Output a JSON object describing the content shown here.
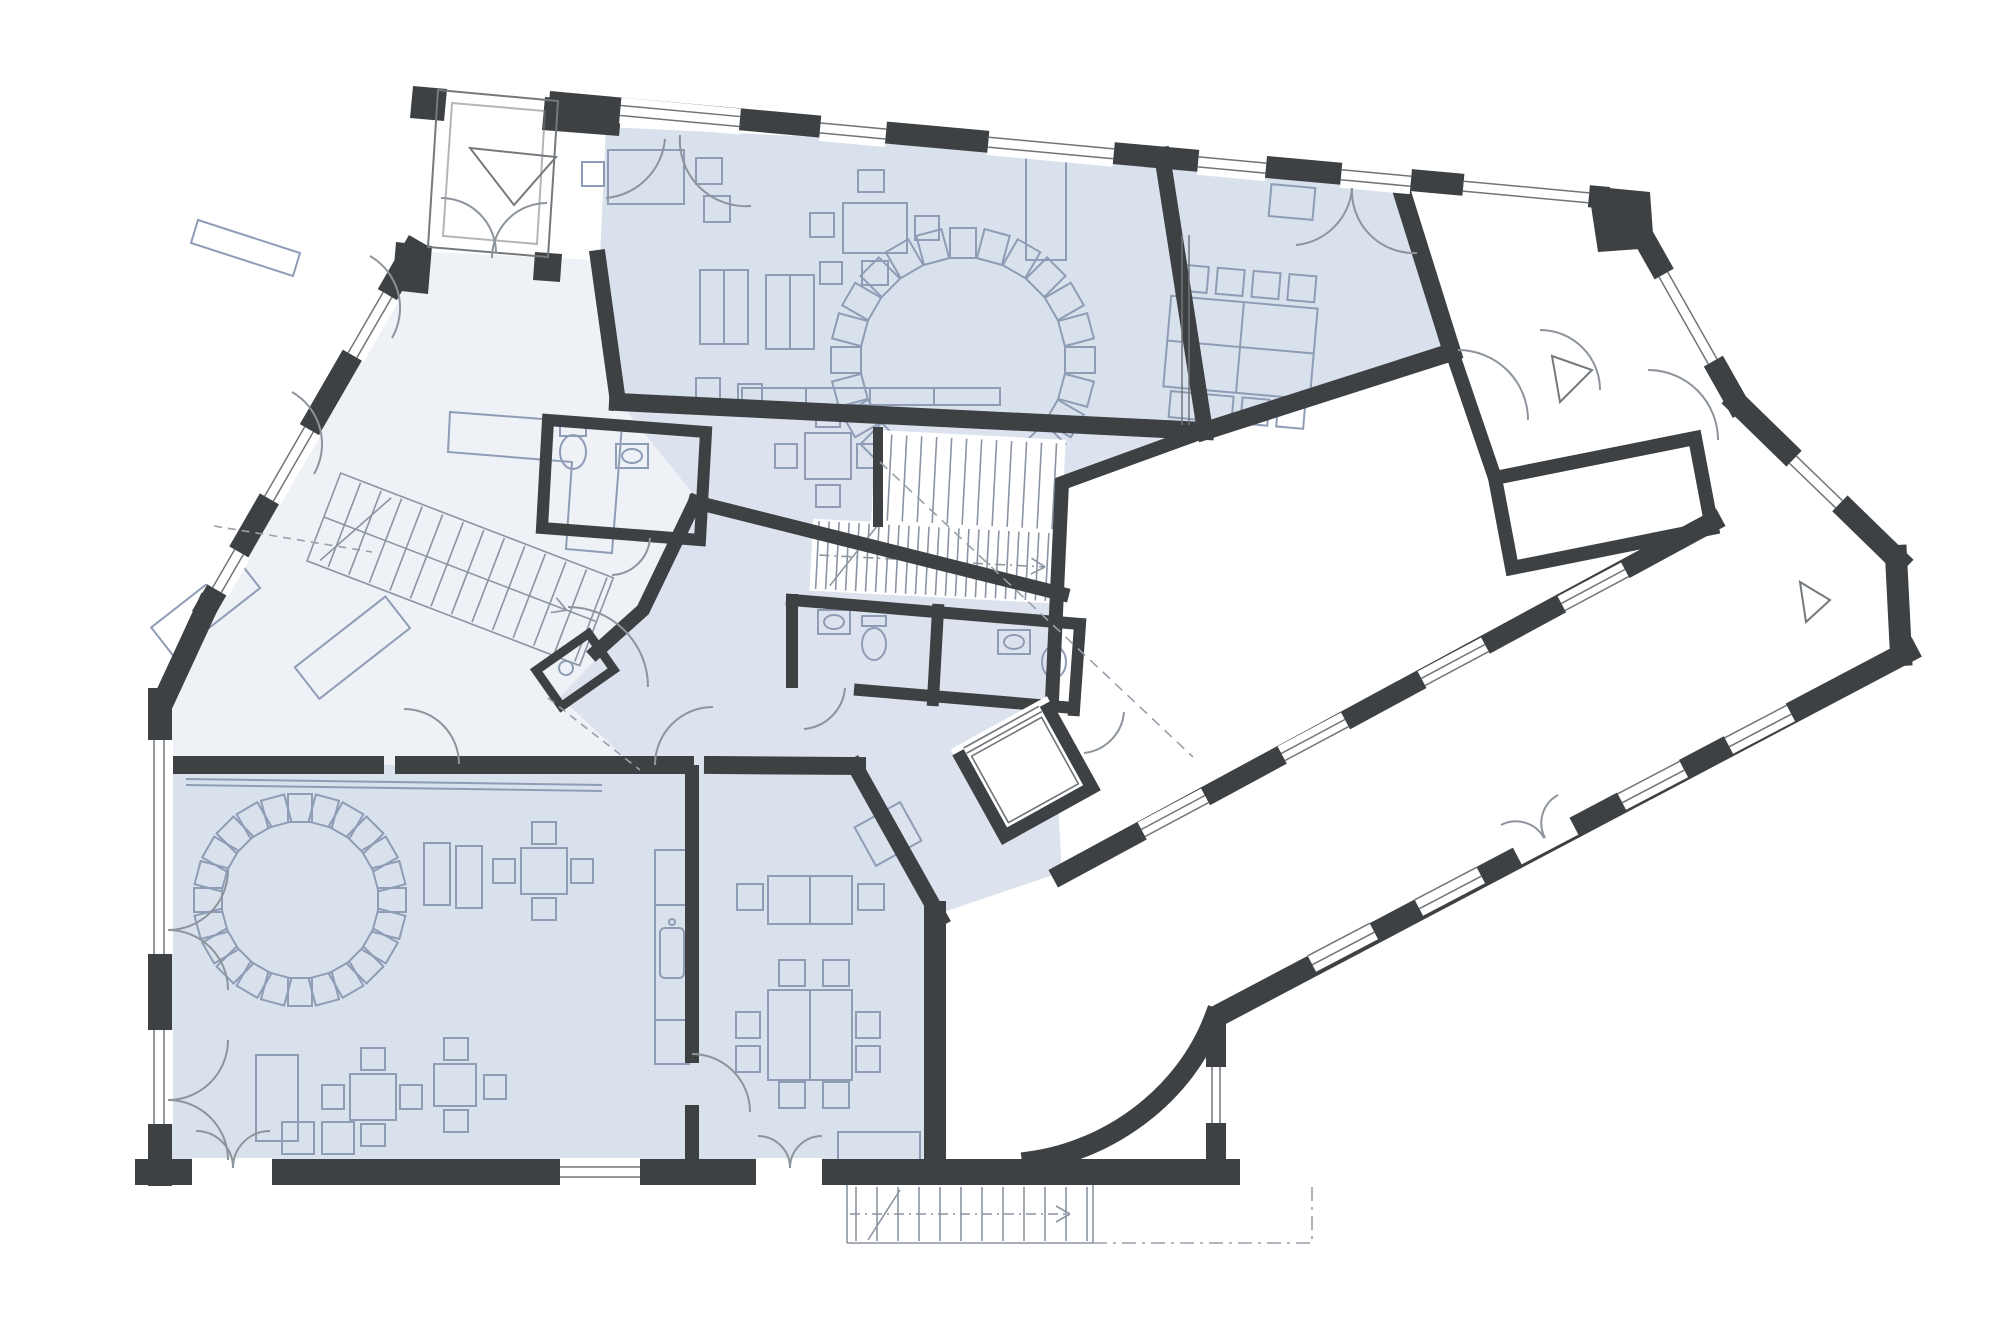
{
  "document": {
    "kind": "architectural floor plan",
    "floor": "ground floor",
    "style": "monochrome line drawing with blue tinted rooms",
    "visible_text": ""
  },
  "colors": {
    "paper": "#ffffff",
    "wall": "#3e4144",
    "room_blue": "#d9e1ed",
    "room_blue_corridor": "#dce3ee",
    "room_pale": "#eef1f6",
    "furniture": "#8e9db5",
    "fixture": "#8e9db5",
    "glazing": "#70757a",
    "door_arc": "#8d949b",
    "stair_line": "#8b94a2",
    "dash_line": "#98a0aa",
    "marker_line": "#74797e",
    "thin_outline": "#74797e"
  },
  "rooms": [
    {
      "name": "entrance-vestibule",
      "fill": "#ffffff"
    },
    {
      "name": "foyer",
      "fill": "#eef1f6"
    },
    {
      "name": "hall",
      "fill": "#d9e1ed"
    },
    {
      "name": "meeting-room",
      "fill": "#d9e1ed"
    },
    {
      "name": "side-entrance-vestibule",
      "fill": "#ffffff"
    },
    {
      "name": "utility-room",
      "fill": "#ffffff"
    },
    {
      "name": "corridor",
      "fill": "#dce3ee"
    },
    {
      "name": "group-room-west",
      "fill": "#d9e1ed"
    },
    {
      "name": "group-room-south",
      "fill": "#d9e1ed"
    },
    {
      "name": "wing-corridor",
      "fill": "#ffffff"
    },
    {
      "name": "courtyard",
      "fill": "#ffffff"
    }
  ],
  "markers": {
    "entrance_triangle_count": 3
  },
  "stairs": {
    "interior_staircases": 2,
    "exterior_staircase": 1
  },
  "chair_circles": [
    {
      "room": "hall",
      "chairs": 24
    },
    {
      "room": "group-room-west",
      "chairs": 24
    }
  ],
  "repeats": {
    "hall_chair_ring": {
      "count": 24,
      "step_deg": 15,
      "cx": 963,
      "cy": 360
    },
    "west_chair_ring": {
      "count": 24,
      "step_deg": 15,
      "cx": 300,
      "cy": 900
    },
    "core_stair_risers": {
      "count": 12,
      "dx": 15,
      "dy": 0
    },
    "core_stair_hatch": {
      "count": 24,
      "dx": 10,
      "dy": 0
    },
    "ext_stair_risers": {
      "count": 12,
      "dx": 21,
      "dy": 0
    },
    "foyer_stair_risers": {
      "count": 13,
      "dx": 22,
      "dy": 0
    }
  }
}
